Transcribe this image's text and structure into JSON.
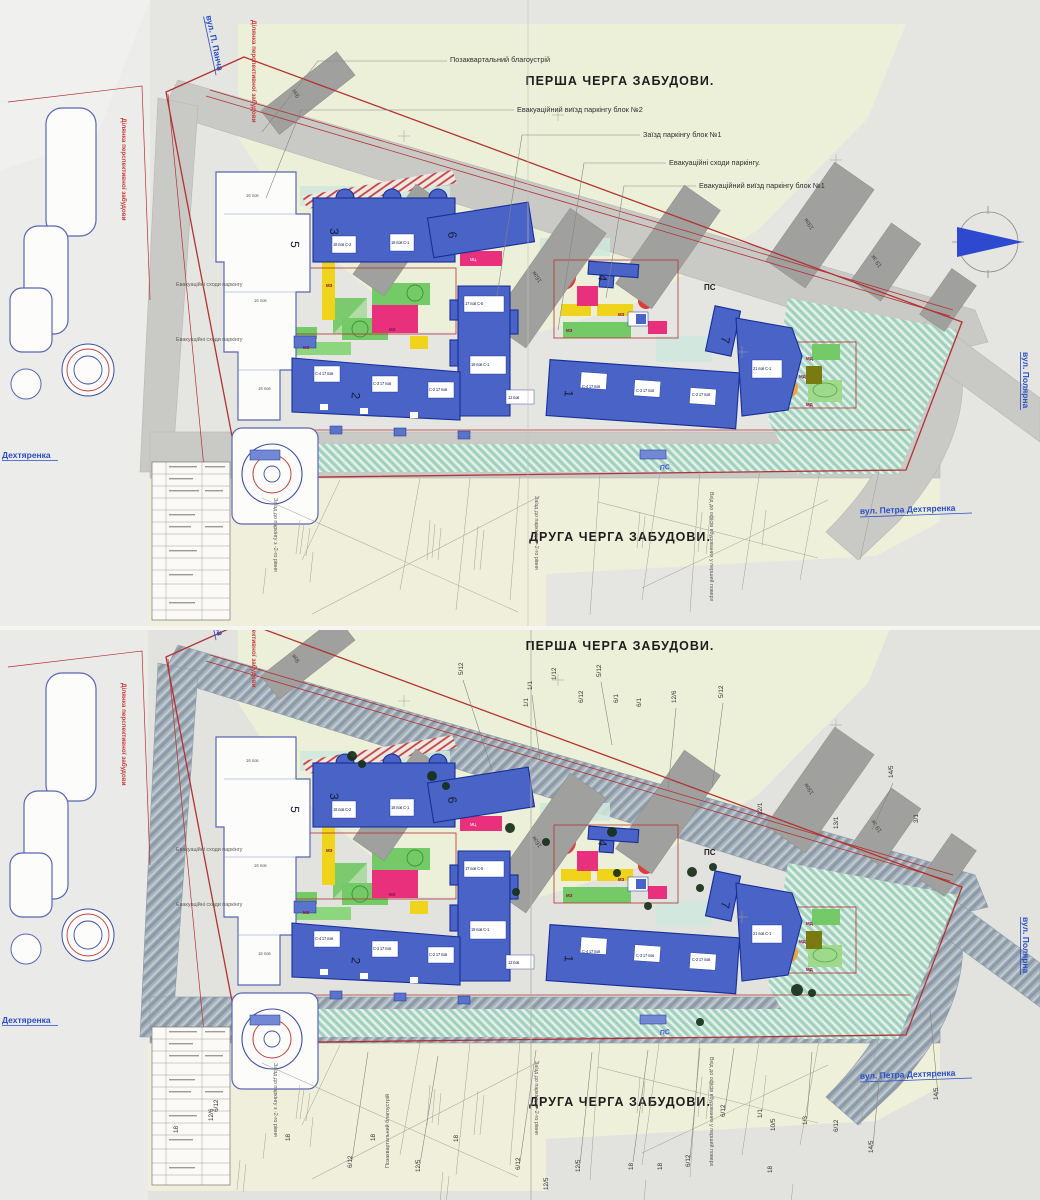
{
  "titles": {
    "first_stage": "ПЕРША ЧЕРГА ЗАБУДОВИ.",
    "second_stage": "ДРУГА ЧЕРГА  ЗАБУДОВИ."
  },
  "streets": {
    "pancha": "вул. П. Панча",
    "polyarna": "вул. Полярна",
    "petra_dehtyarenka": "вул. Петра Дехтяренка",
    "dehtyarenka": "Дехтяренка"
  },
  "notes": {
    "perspective_area": "Ділянка перспективної забудови",
    "parking_entry_level": "Заїзд до паркінгу з -2-го рівня",
    "office_entry": "Вхід до офісів вбудованих у перший поверх",
    "ps": "ПС"
  },
  "callouts": {
    "offsite_improvement": "Позаквартальний благоустрій",
    "evac_exit_block2": "Евакуаційний виїзд паркінгу блок №2",
    "parking_entry_block1": "Заїзд паркінгу блок №1",
    "evac_stairs": "Евакуаційні сходи паркінгу.",
    "evac_exit_block1": "Евакуаційний виїзд паркінгу блок №1",
    "evac_stairs_2": "Евакуаційні сходи паркінгу",
    "evac_stairs_3": "Евакуаційні сходи паркінгу"
  },
  "existing_buildings": [
    "9эк",
    "16эк",
    "16эк",
    "19эк",
    "19 эк"
  ],
  "buildings": {
    "n1": "1",
    "n2": "2",
    "n3": "3",
    "n4": "4",
    "n5": "5",
    "n6": "6",
    "n7": "7",
    "sec_c4_17": "С-4 17 пов",
    "sec_c3_17": "С-3 17 пов",
    "sec_c2_17": "С-2 17 пов",
    "sec_18_c2": "18 пов С-2",
    "sec_18_c1": "18 пов С-1",
    "tower_17_c5": "17 пов С-5",
    "tower_19_c1": "19 пов С-1",
    "annex_12": "12 пов",
    "corner_21_c1": "21 пов С-1",
    "floors_16": "16 пов",
    "tag_mz": "МЗ",
    "tag_md": "МД",
    "tag_mc": "МЦ"
  },
  "fractions_upper": [
    "5/12",
    "1/1",
    "1/1",
    "1/12",
    "5/12",
    "6/12",
    "6/1",
    "6/1",
    "12/6",
    "5/12",
    "12/1",
    "13/1",
    "14/5",
    "3/1"
  ],
  "fractions_lower": [
    "6/12",
    "12/6",
    "18",
    "18",
    "18",
    "6/12",
    "12/5",
    "6/12",
    "12/5",
    "18",
    "18",
    "6/12",
    "6/12",
    "1/1",
    "10/5",
    "1/3",
    "6/12",
    "14/5",
    "18",
    "14/5",
    "18",
    "12/5"
  ],
  "palette": {
    "building_blue": "#4a63c6",
    "existing_gray": "#a0a09e",
    "lawn_green": "#74ca66",
    "playground_magenta": "#e8307c",
    "zone_yellow": "#f0d31b",
    "landscape_teal": "#b5dccb",
    "boundary_red": "#b23232",
    "street_label_blue": "#2a4ec6",
    "stage_zone_beige": "#edf0d8",
    "north_arrow_blue": "#2d49cf"
  }
}
